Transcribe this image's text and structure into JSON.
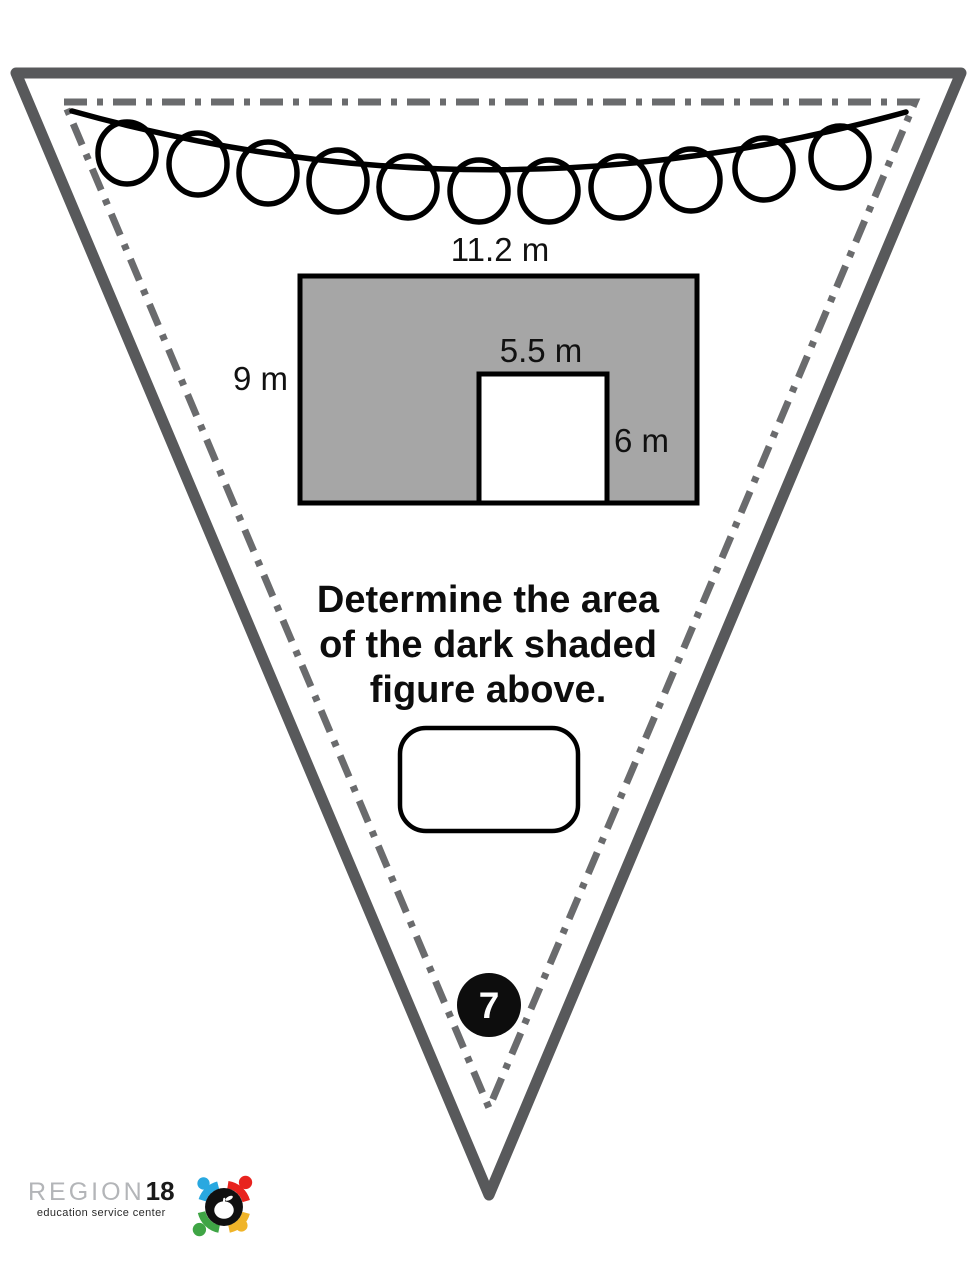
{
  "pennant": {
    "badge_number": "7",
    "question_lines": [
      "Determine the area",
      "of the dark shaded",
      "figure above."
    ],
    "figure_labels": {
      "outer_width": "11.2 m",
      "outer_height": "9 m",
      "cutout_width": "5.5 m",
      "cutout_height": "6 m"
    }
  },
  "logo": {
    "name": "REGION",
    "number": "18",
    "tagline": "education service center"
  },
  "colors": {
    "outer_border": "#58595B",
    "dash_border": "#6A6B6D",
    "figure_fill": "#A6A6A6",
    "badge_fill": "#0D0D0D",
    "logo_red": "#E8231E",
    "logo_blue": "#29A8E0",
    "logo_green": "#3FA545",
    "logo_yellow": "#F0B429"
  }
}
